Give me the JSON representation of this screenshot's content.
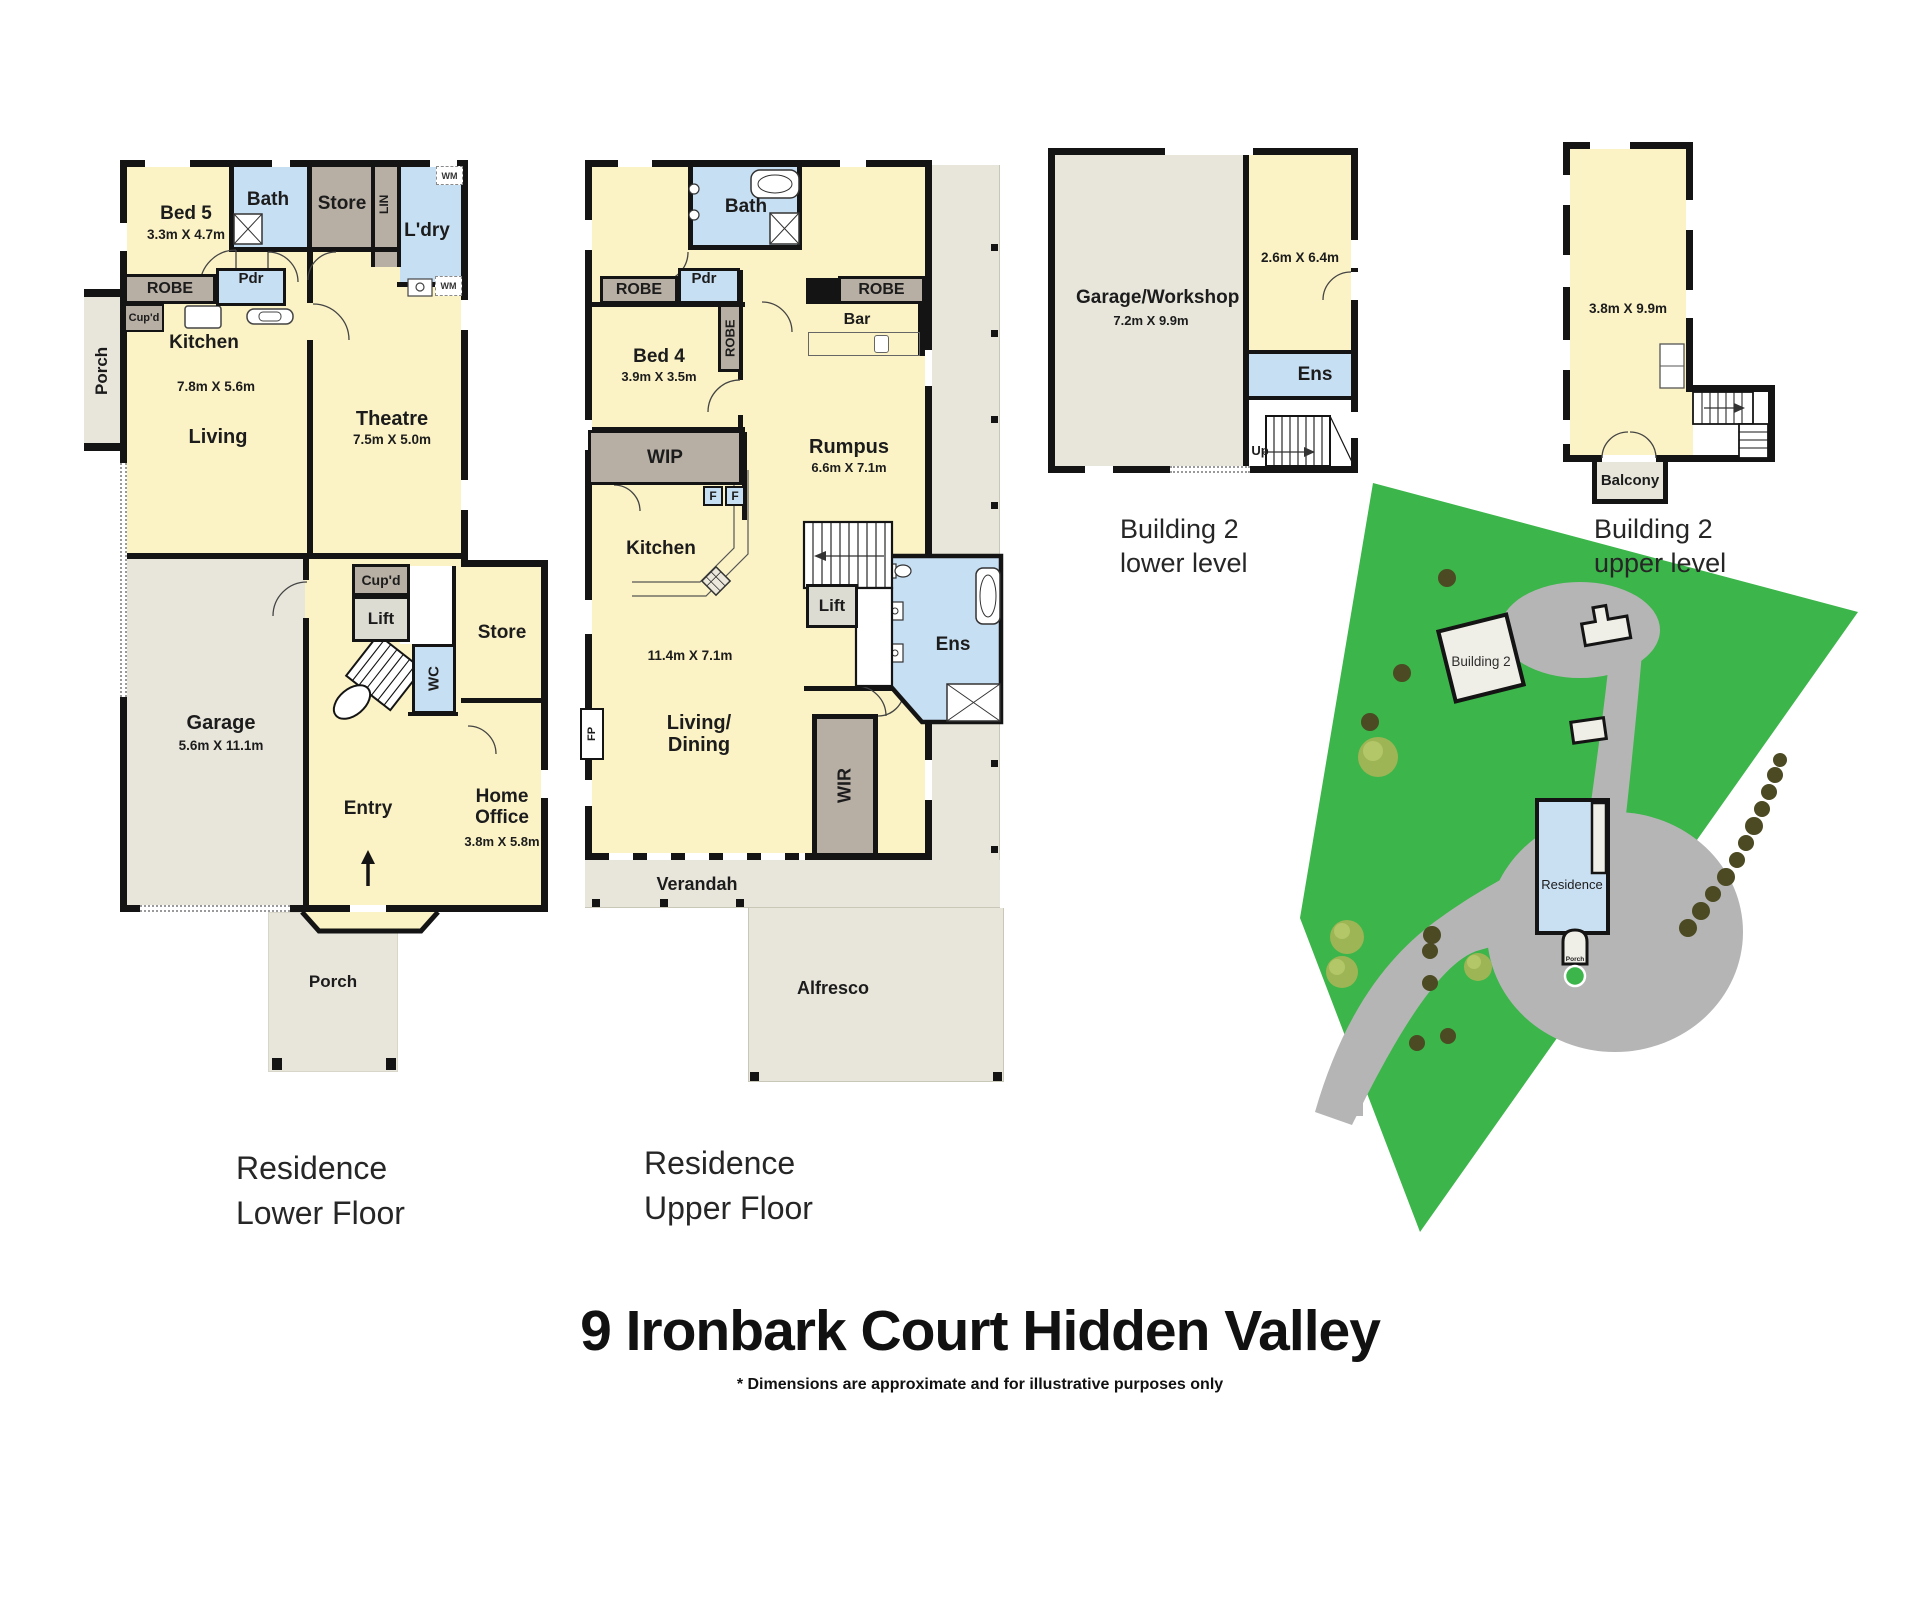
{
  "footer": {
    "title": "9 Ironbark Court Hidden Valley",
    "disclaimer": "* Dimensions are approximate and for illustrative purposes only"
  },
  "captions": {
    "lower": "Residence\nLower Floor",
    "upper": "Residence\nUpper Floor",
    "b2_lower": "Building 2\nlower level",
    "b2_upper": "Building 2\nupper level"
  },
  "lower_floor": {
    "bed5": "Bed 5",
    "bed5_dim": "3.3m X 4.7m",
    "bath": "Bath",
    "store_top": "Store",
    "lin": "LIN",
    "laundry": "L'dry",
    "wm": "WM",
    "robe": "ROBE",
    "powder": "Pdr",
    "cupboard": "Cup'd",
    "kitchen": "Kitchen",
    "living": "Living",
    "living_dim": "7.8m X 5.6m",
    "theatre": "Theatre",
    "theatre_dim": "7.5m X 5.0m",
    "porch": "Porch",
    "lift": "Lift",
    "wc": "WC",
    "store_mid": "Store",
    "garage": "Garage",
    "garage_dim": "5.6m X 11.1m",
    "entry": "Entry",
    "home_office": "Home Office",
    "home_office_dim": "3.8m X 5.8m"
  },
  "upper_floor": {
    "bath": "Bath",
    "robe": "ROBE",
    "powder": "Pdr",
    "bed4": "Bed 4",
    "bed4_dim": "3.9m X 3.5m",
    "bar": "Bar",
    "rumpus": "Rumpus",
    "rumpus_dim": "6.6m X 7.1m",
    "wip": "WIP",
    "fridge": "F",
    "kitchen": "Kitchen",
    "area_dim": "11.4m X 7.1m",
    "lift": "Lift",
    "ens": "Ens",
    "fireplace": "FP",
    "living_dining": "Living/\nDining",
    "wir": "WIR",
    "verandah": "Verandah",
    "alfresco": "Alfresco"
  },
  "building2_lower": {
    "garage_workshop": "Garage/Workshop",
    "garage_dim": "7.2m X 9.9m",
    "room_dim": "2.6m X 6.4m",
    "ens": "Ens",
    "up": "Up"
  },
  "building2_upper": {
    "room_dim": "3.8m X 9.9m",
    "balcony": "Balcony"
  },
  "site_plan": {
    "building2": "Building 2",
    "residence": "Residence",
    "porch": "Porch"
  },
  "colors": {
    "wall": "#141414",
    "room_yellow": "#FBF3C5",
    "wet_blue": "#C7DFF3",
    "storage_taupe": "#B7AEA4",
    "paved_gray": "#E8E6DB",
    "lift_gray": "#DDDCD3",
    "site_green": "#3CB54A",
    "driveway_gray": "#B5B5B5",
    "residence_blue": "#C9E0F2"
  }
}
